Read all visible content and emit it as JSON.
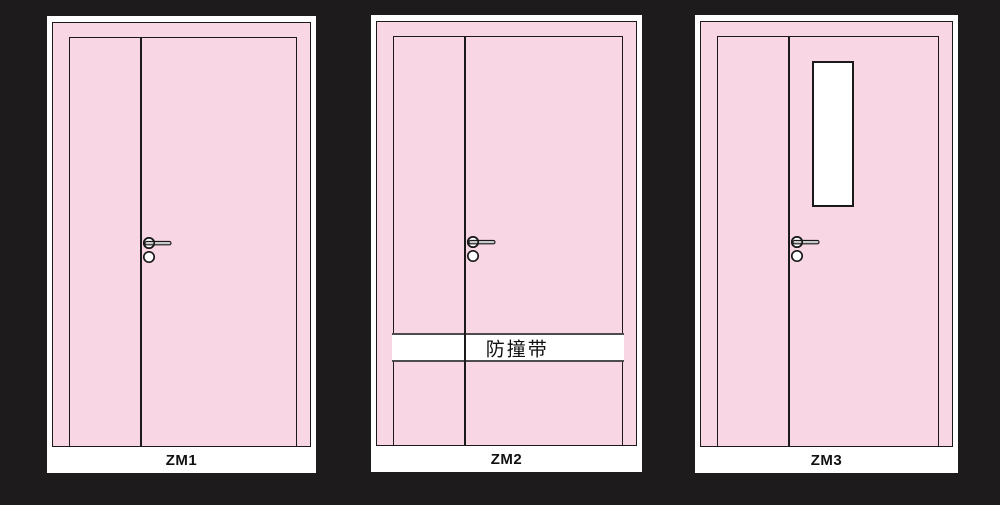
{
  "title": "Door elevation drawings",
  "colors": {
    "background": "#1e1b1c",
    "panel_background": "#ffffff",
    "door_pink": "#f8d6e4",
    "outline": "#1a1a1a",
    "band_border": "#4d4d4d",
    "lever_gray": "#c9c9c9"
  },
  "panels": [
    {
      "label": "ZM1"
    },
    {
      "label": "ZM2",
      "band_label": "防撞带"
    },
    {
      "label": "ZM3"
    }
  ]
}
